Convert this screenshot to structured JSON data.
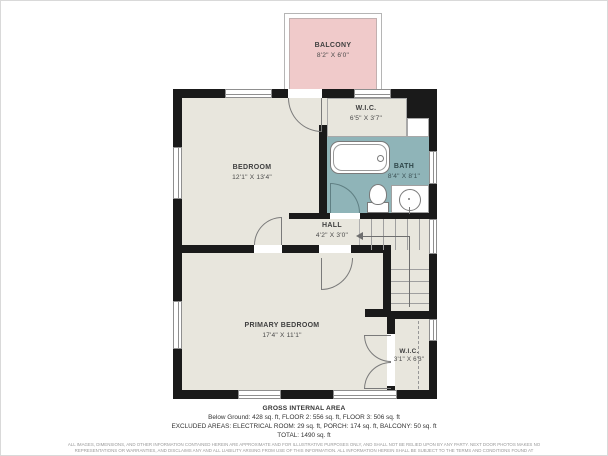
{
  "colors": {
    "wall": "#1a1a1a",
    "floor": "#e8e6dd",
    "bath_floor": "#8fb4b8",
    "balcony": "#f0caca",
    "label_text": "#3f3f3f"
  },
  "balcony": {
    "name": "BALCONY",
    "dims": "8'2\" X 6'0\""
  },
  "rooms": {
    "bedroom": {
      "name": "BEDROOM",
      "dims": "12'1\" X 13'4\""
    },
    "wic_top": {
      "name": "W.I.C.",
      "dims": "6'5\" X 3'7\""
    },
    "bath": {
      "name": "BATH",
      "dims": "8'4\" X 8'1\""
    },
    "hall": {
      "name": "HALL",
      "dims": "4'2\" X 3'0\""
    },
    "primary": {
      "name": "PRIMARY BEDROOM",
      "dims": "17'4\" X 11'1\""
    },
    "wic_bottom": {
      "name": "W.I.C.",
      "dims": "3'1\" X 6'3\""
    }
  },
  "footer": {
    "title": "GROSS INTERNAL AREA",
    "line1": "Below Ground: 428 sq. ft, FLOOR 2: 556 sq. ft, FLOOR 3: 506 sq. ft",
    "line2": "EXCLUDED AREAS: ELECTRICAL ROOM: 29 sq. ft, PORCH: 174 sq. ft, BALCONY: 50 sq. ft",
    "line3": "TOTAL: 1490 sq. ft",
    "disclaimer": "ALL IMAGES, DIMENSIONS, AND OTHER INFORMATION CONTAINED HEREIN ARE APPROXIMATE AND FOR ILLUSTRATIVE PURPOSES ONLY, AND SHALL NOT BE RELIED UPON BY ANY PARTY. NEXT DOOR PHOTOS MAKES NO REPRESENTATIONS OR WARRANTIES, AND DISCLAIMS ANY AND ALL LIABILITY ARISING FROM USE OF THIS INFORMATION. ALL INFORMATION HEREIN SHALL BE SUBJECT TO THE TERMS AND CONDITIONS FOUND AT NEXTDOORPHOTOS.COM/TC."
  }
}
